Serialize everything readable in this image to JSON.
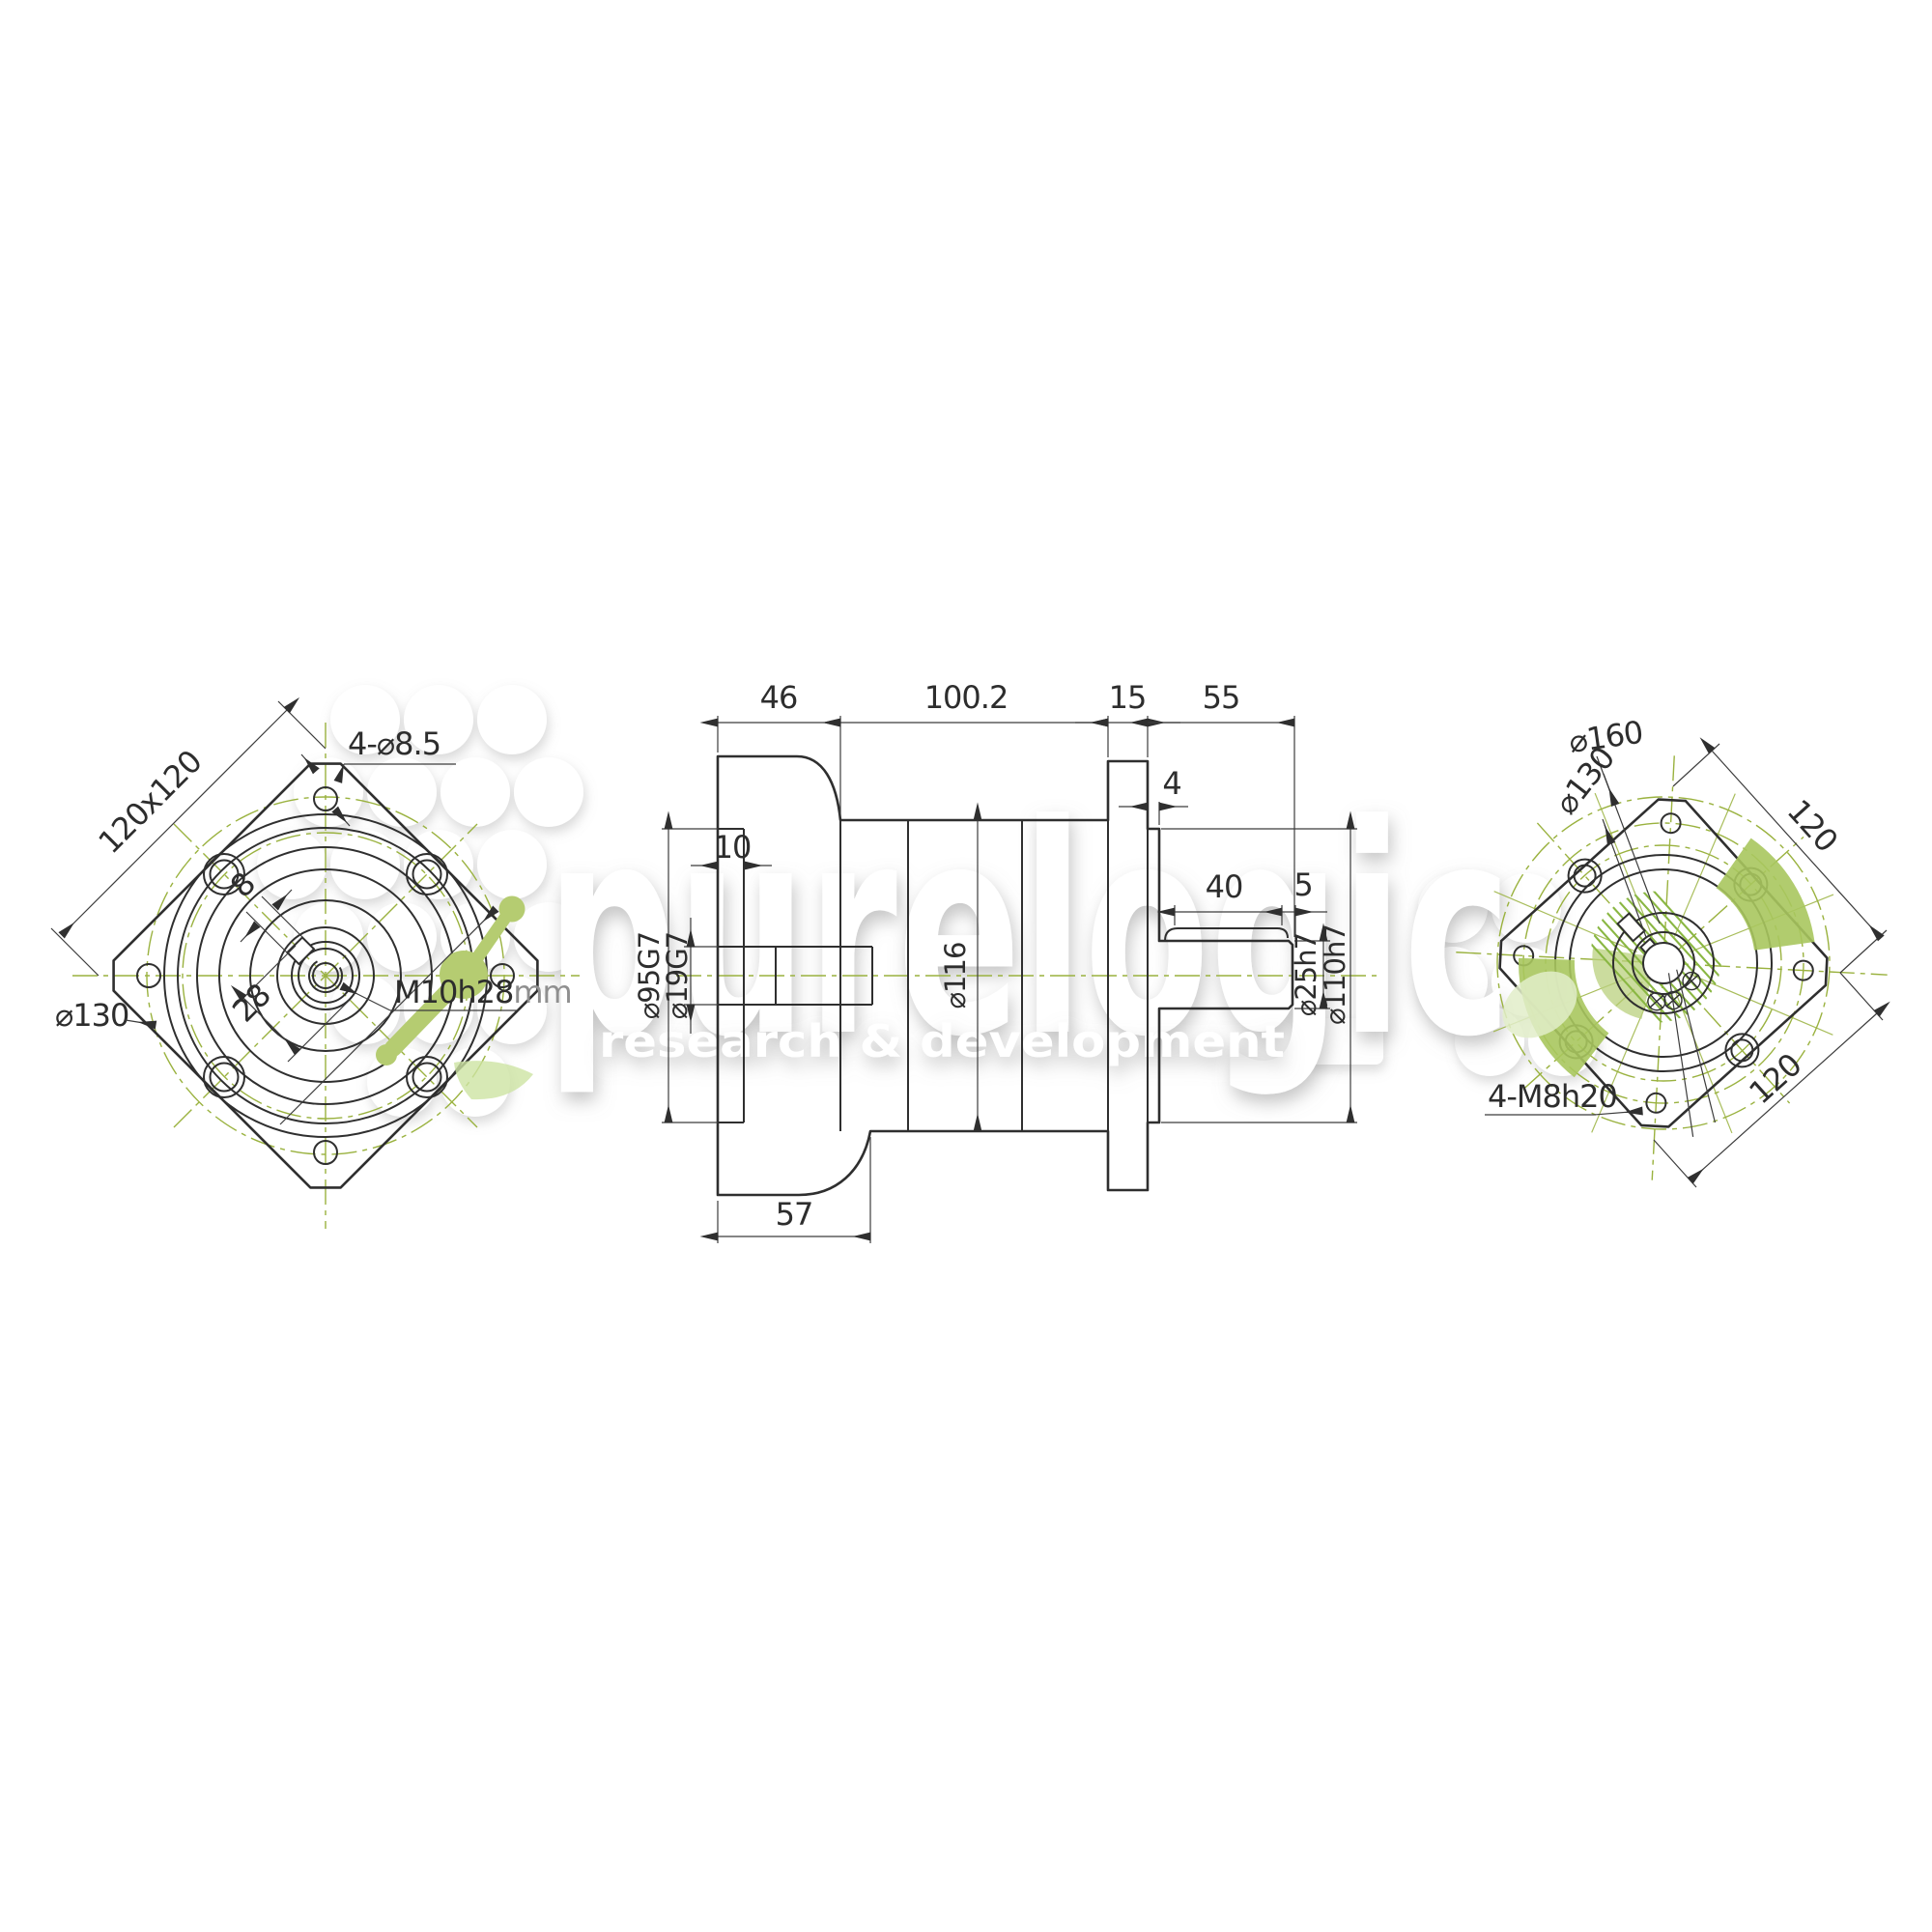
{
  "watermark": {
    "brand": "purelogic",
    "tagline": "research & development"
  },
  "colors": {
    "line": "#2f2f2f",
    "centerline_green": "#9ab23f",
    "logo_green": "#b5cc71",
    "dim_text": "#2d2d2d",
    "unit_text": "#8f8f8f",
    "background": "#ffffff"
  },
  "views": {
    "front": {
      "square_dim": "120x120",
      "corner_holes": "4-⌀8.5",
      "bolt_circle": "⌀130",
      "key_width": "8",
      "key_span": "28",
      "center_tap": "M10h28",
      "center_tap_unit": "mm"
    },
    "side": {
      "flange_depth": "46",
      "body_length": "100.2",
      "flange_thickness": "15",
      "shaft_length": "55",
      "recess_depth": "10",
      "pilot_step": "4",
      "key_length": "40",
      "key_end_offset": "5",
      "pilot_dia": "⌀95G7",
      "input_bore_dia": "⌀19G7",
      "body_dia": "⌀116",
      "shaft_dia": "⌀25h7",
      "pilot_boss_dia": "⌀110h7",
      "flange_total_depth": "57"
    },
    "rear": {
      "chamfer_circle_dia": "⌀160",
      "bolt_circle_dia": "⌀130",
      "square_top": "120",
      "square_bottom": "120",
      "corner_taps": "4-M8h20"
    }
  }
}
